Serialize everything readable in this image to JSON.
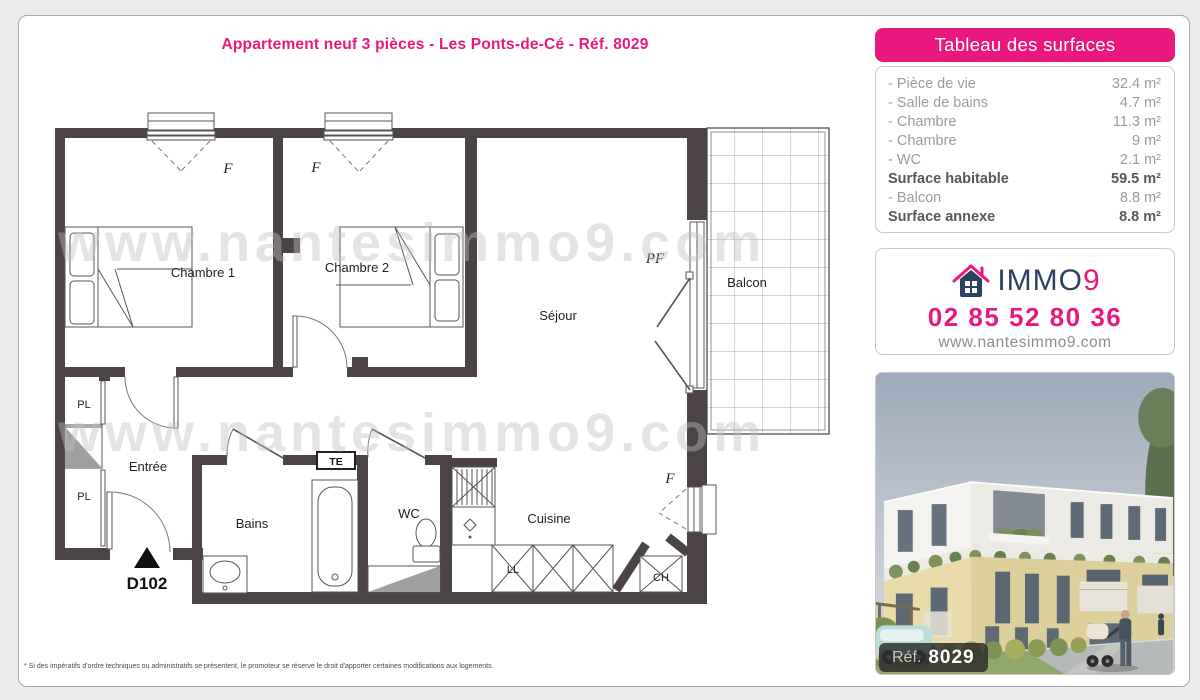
{
  "title": "Appartement neuf 3 pièces - Les Ponts-de-Cé - Réf. 8029",
  "footnote": "* Si des impératifs d'ordre techniques ou administratifs se présentent, le promoteur se réserve le droit d'apporter certaines modifications aux logements.",
  "surfaces": {
    "header": "Tableau des surfaces",
    "rows": [
      {
        "label": "- Pièce de vie",
        "value": "32.4 m²"
      },
      {
        "label": "- Salle de bains",
        "value": "4.7 m²"
      },
      {
        "label": "- Chambre",
        "value": "11.3 m²"
      },
      {
        "label": "- Chambre",
        "value": "9 m²"
      },
      {
        "label": "- WC",
        "value": "2.1 m²"
      },
      {
        "label": "Surface habitable",
        "value": "59.5 m²"
      },
      {
        "label": "- Balcon",
        "value": "8.8 m²"
      },
      {
        "label": "Surface annexe",
        "value": "8.8 m²"
      }
    ]
  },
  "agency": {
    "brand_immo": "IMMO",
    "brand_9": "9",
    "phone": "02 85 52 80 36",
    "website": "www.nantesimmo9.com"
  },
  "photo": {
    "ref_label": "Réf.",
    "ref_number": "8029"
  },
  "plan": {
    "watermark": "www.nantesimmo9.com",
    "labels": {
      "chambre1": "Chambre 1",
      "chambre2": "Chambre 2",
      "sejour": "Séjour",
      "balcon": "Balcon",
      "entree": "Entrée",
      "bains": "Bains",
      "wc": "WC",
      "cuisine": "Cuisine",
      "pl": "PL",
      "ll": "LL",
      "ch": "CH",
      "te": "TE",
      "door_number": "D102",
      "f": "F",
      "pf": "PF"
    }
  },
  "colors": {
    "accent_pink": "#e8187d",
    "brand_navy": "#2e4160",
    "wall_gray": "#4c4444"
  }
}
